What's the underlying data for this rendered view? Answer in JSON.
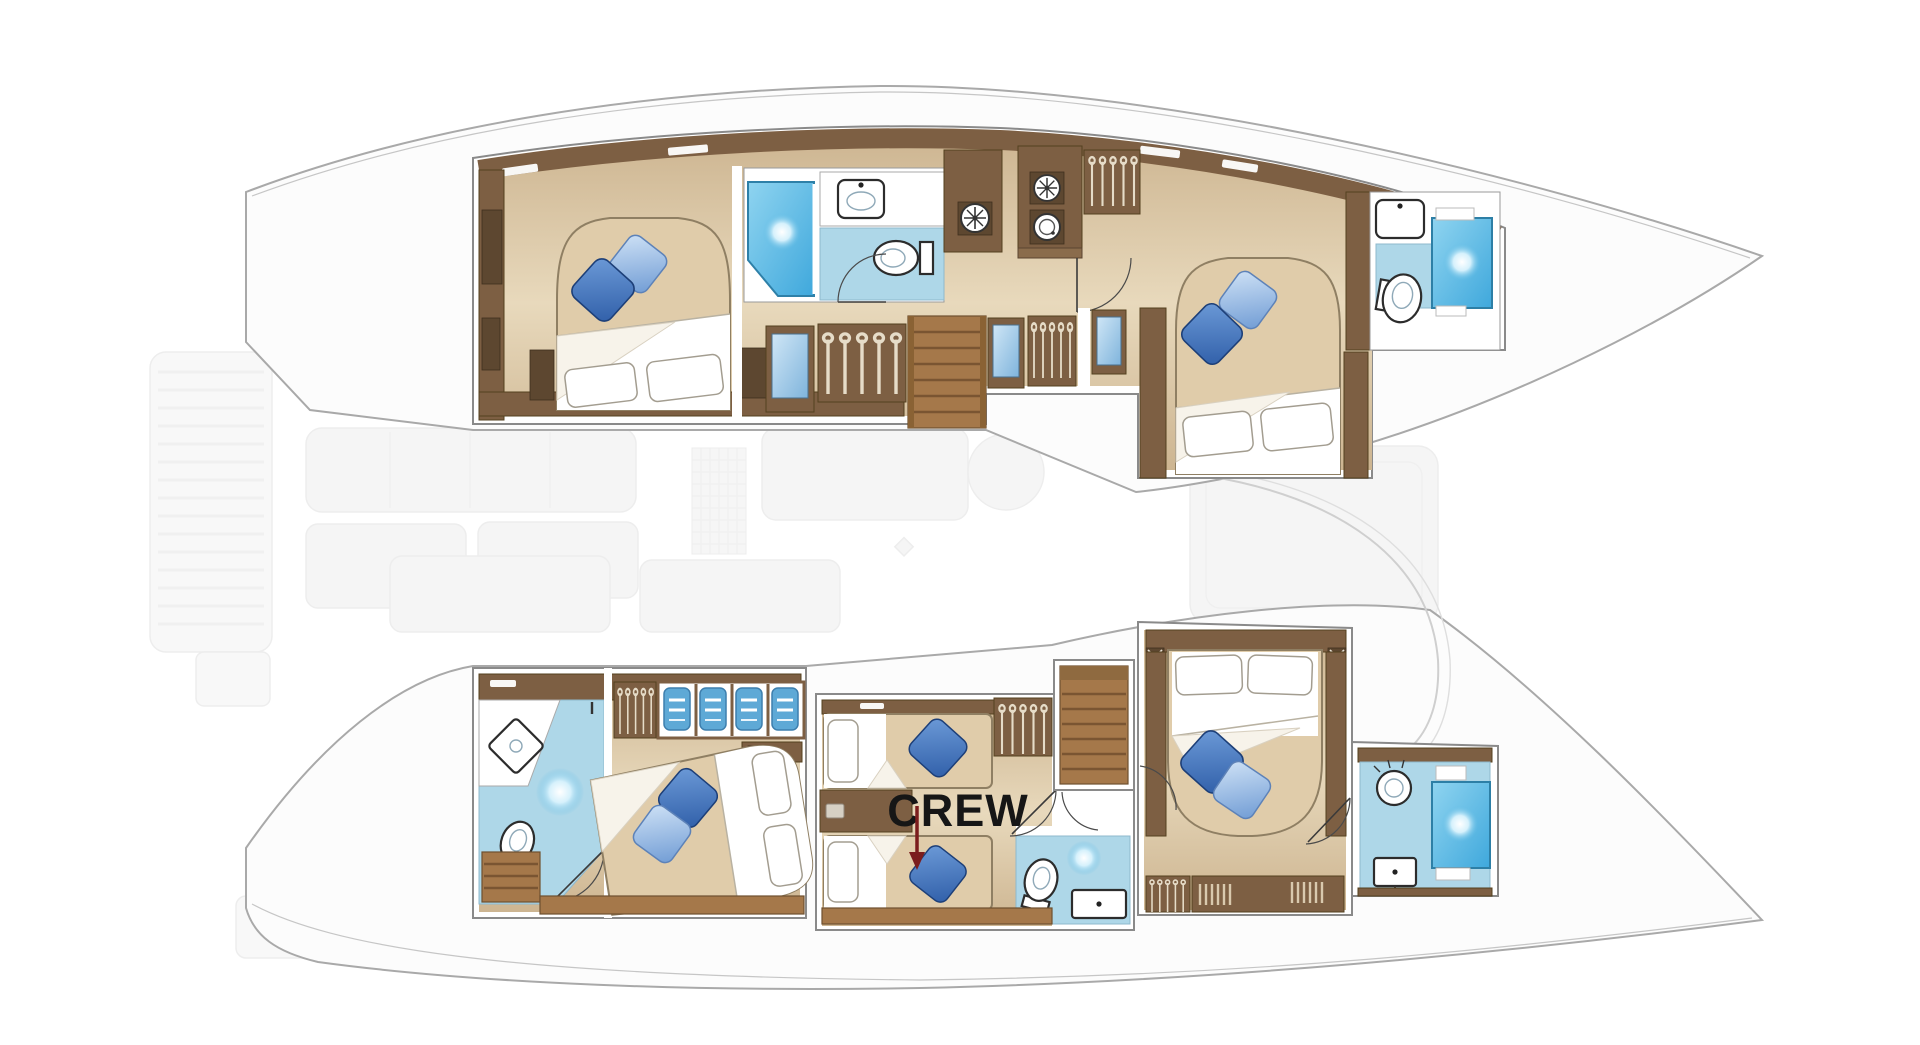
{
  "labels": {
    "crew": "CREW"
  },
  "plan": {
    "type": "catamaran-lower-deck-floorplan",
    "colors": {
      "background": "#ffffff",
      "hull_outline": "#a9a9a9",
      "cabin_block_border": "#8a8a8a",
      "wood_wall_dark": "#7d5f43",
      "wood_light": "#a5784a",
      "floor_tan": "#dcc7a4",
      "bathroom_floor_blue": "#aed7e8",
      "shower_blue": "#54b7e3",
      "pillow_blue_dark": "#2f5ea8",
      "pillow_blue_light": "#8fb6e6",
      "bed_linen_white": "#ffffff",
      "duvet_tan": "#e0ccaa",
      "crew_text": "#161616",
      "crew_arrow": "#7b1d1d",
      "ghost_furniture": "#ededed"
    },
    "glyphs": {
      "shower-icon": "blue panel with radial shine",
      "toilet-icon": "white ellipse bowl with tank",
      "sink-icon": "white rounded basin with faucet dot",
      "wardrobe-icon": "hanger strokes on wood",
      "washer-icon": "circle with drum blades",
      "vent-fan-icon": "spoked circle",
      "stairs-icon": "wood treads",
      "door-swing-icon": "quarter arc",
      "double-bed-icon": "duvet with two pillows",
      "crew-arrow-icon": "dark red down arrow"
    }
  }
}
